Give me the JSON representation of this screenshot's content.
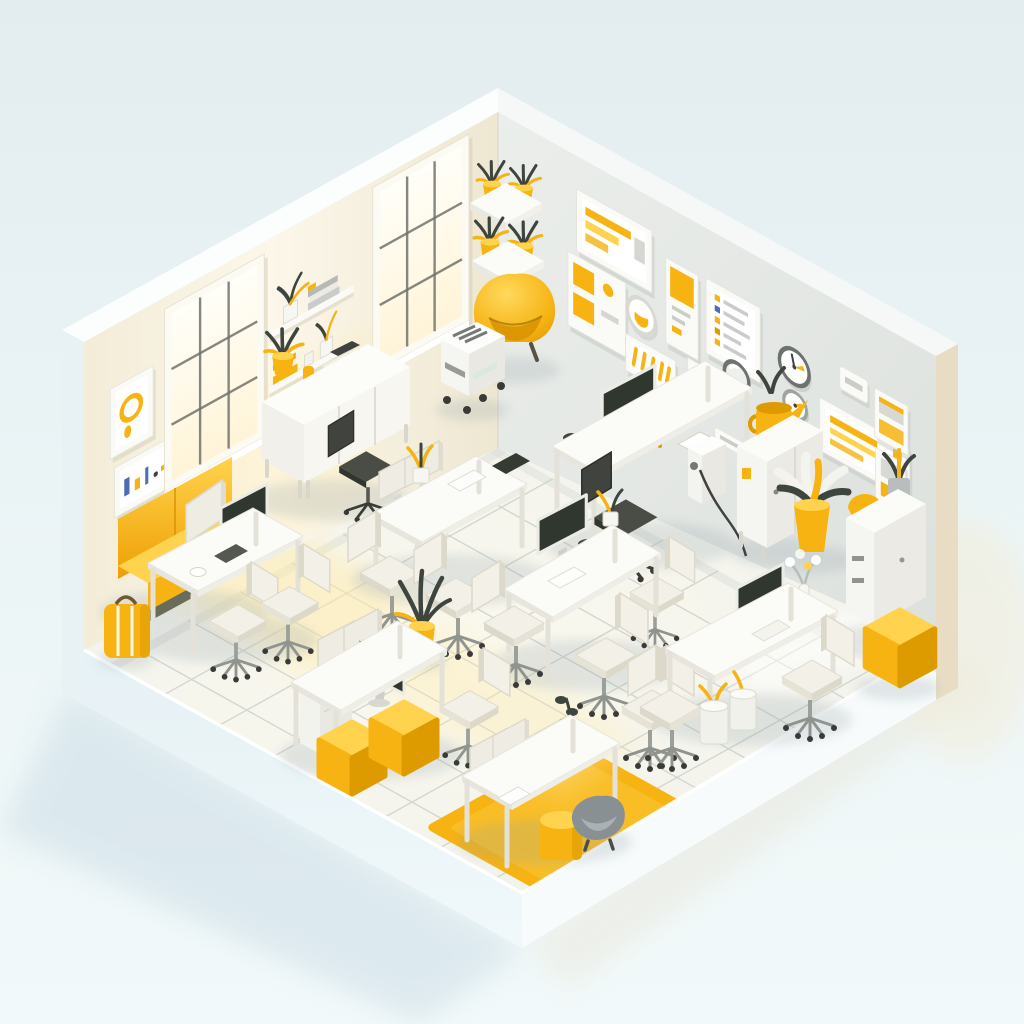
{
  "scene": {
    "type": "isometric-3d-office-illustration",
    "style": "minimal white and yellow low-poly render",
    "room": {
      "walls_visible": 2,
      "windows_on_left_wall": 2,
      "floor": "white tile grid",
      "base": "white diorama plinth with soft cast shadows"
    },
    "objects": [
      {
        "name": "window",
        "count": 2
      },
      {
        "name": "wall-art-frame-left-wall",
        "count": 2
      },
      {
        "name": "wall-art-frame-right-wall",
        "count": 10
      },
      {
        "name": "wall-plaque",
        "count": 2
      },
      {
        "name": "wall-clock",
        "count": 2
      },
      {
        "name": "wall-shelf",
        "count": 2
      },
      {
        "name": "corner-shelf",
        "count": 2
      },
      {
        "name": "desk",
        "count": 7
      },
      {
        "name": "sideboard-console",
        "count": 1
      },
      {
        "name": "office-chair-white",
        "count": 9
      },
      {
        "name": "office-chair-dark",
        "count": 2
      },
      {
        "name": "saucer-chair",
        "count": 1
      },
      {
        "name": "monitor-dark",
        "count": 6
      },
      {
        "name": "monitor-back-panel",
        "count": 6
      },
      {
        "name": "ottoman-cube",
        "count": 3
      },
      {
        "name": "sofa-yellow",
        "count": 1
      },
      {
        "name": "armchair-yellow",
        "count": 1
      },
      {
        "name": "potted-plant",
        "count": 10
      },
      {
        "name": "printer-cart",
        "count": 1
      },
      {
        "name": "locker-cabinet",
        "count": 2
      },
      {
        "name": "drawer-pedestal",
        "count": 1
      },
      {
        "name": "rug-yellow",
        "count": 1
      },
      {
        "name": "desk-lamp-yellow",
        "count": 1
      },
      {
        "name": "bag-yellow",
        "count": 1
      },
      {
        "name": "waste-bin",
        "count": 2
      },
      {
        "name": "stool-cylinder-yellow",
        "count": 1
      },
      {
        "name": "mug-yellow",
        "count": 2
      },
      {
        "name": "flower-vase",
        "count": 1
      },
      {
        "name": "books-stack",
        "count": 3
      },
      {
        "name": "keyboard",
        "count": 3
      },
      {
        "name": "laptop",
        "count": 2
      }
    ]
  },
  "palette": {
    "bgTop": "#e3edf0",
    "bgMid": "#ecf5f6",
    "bgBottom": "#f2f9fa",
    "wallLeft": "#f6f0df",
    "wallLeftLit": "#fcf7ea",
    "wallLeftShade": "#eee7d2",
    "wallRight": "#e9ece9",
    "wallRightDark": "#dde1de",
    "wallTop": "#fcfdfd",
    "capLeft": "#e8f1f4",
    "capRight": "#e8ddc4",
    "floor": "#f2f4f0",
    "grout": "#c6ccc7",
    "plinthLeft": "#e6f1f5",
    "plinthRight": "#f8fbfb",
    "accent": "#f6b312",
    "accentLight": "#ffd34d",
    "accentDeep": "#dd9b00",
    "screen": "#343b33",
    "leaf": "#3e453f",
    "chairWhite": "#f3f0e7",
    "chairShade": "#dcd8ca",
    "metal": "#9ba09b",
    "ink": "#3f423e",
    "sunlight": "#ffe9a6",
    "glass": "#fffdf2",
    "frameWhite": "#fafaf7",
    "shadowCool": "#c9dbe4",
    "shadowWarm": "#e7e3d2",
    "blueMark": "#4f6db3",
    "redMark": "#d4694f"
  }
}
